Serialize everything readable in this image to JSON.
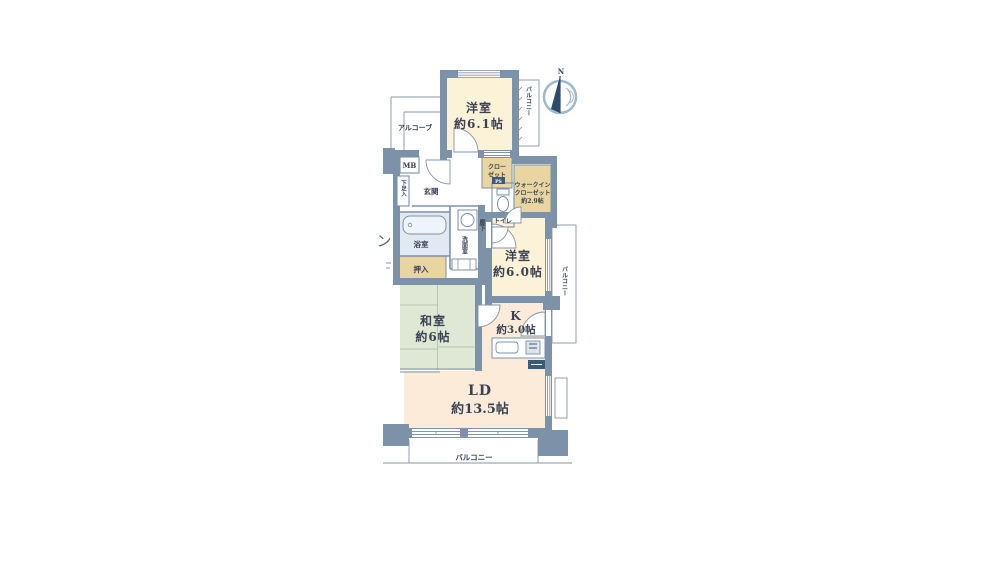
{
  "labels": {
    "compass_n": "N",
    "cutoff": "ン",
    "balcony_top": "バルコニー",
    "balcony_right": "バルコニー",
    "balcony_bottom": "バルコニー",
    "alcove": "アルコーブ",
    "mb": "MB",
    "ps": "PS",
    "closet_l1": "クロー",
    "closet_l2": "ゼット",
    "wic_l1": "ウォークイン",
    "wic_l2": "クローゼット",
    "wic_l3": "約2.9帖",
    "toilet": "トイレ",
    "genkan": "玄関",
    "shoe": "下足入",
    "bath": "浴室",
    "washroom": "洗面室",
    "hallway": "廊下",
    "oshiire": "押入",
    "yoshitsu61_name": "洋室",
    "yoshitsu61_size": "約6.1帖",
    "yoshitsu60_name": "洋室",
    "yoshitsu60_size": "約6.0帖",
    "washitsu_name": "和室",
    "washitsu_size": "約6帖",
    "kitchen_name": "K",
    "kitchen_size": "約3.0帖",
    "ld_name": "LD",
    "ld_size": "約13.5帖"
  },
  "colors": {
    "wall": "#7b92a8",
    "room_cream": "#fbf2d7",
    "closet_tan": "#e9d5a0",
    "ld_peach": "#fcebd8",
    "tatami_green": "#dee8d5",
    "bath_blue": "#e1eaf2",
    "text": "#3a4254",
    "compass_navy": "#2c4a6e"
  }
}
